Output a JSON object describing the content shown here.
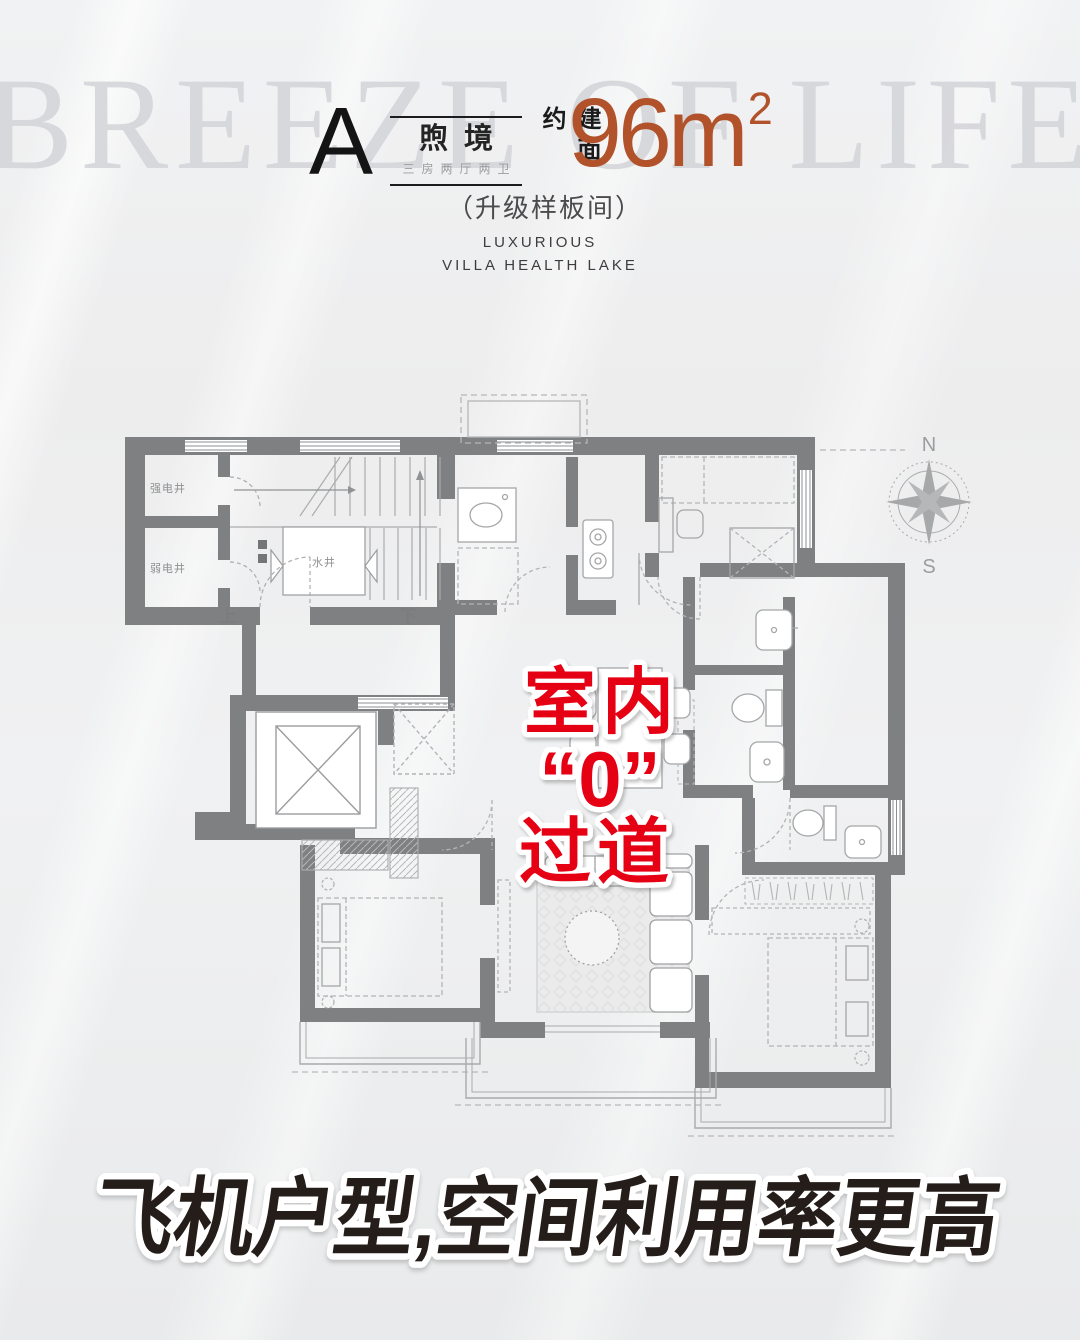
{
  "watermark_text": "BREEZE OF LIFE",
  "header": {
    "unit_letter": "A",
    "series_name": "煦境",
    "room_config": "三房两厅两卫",
    "area_prefix": "建面约",
    "area_number": "96m",
    "area_exponent": "2",
    "upgrade_note": "（升级样板间）",
    "en_tagline_line1": "LUXURIOUS",
    "en_tagline_line2": "VILLA HEALTH LAKE"
  },
  "floor_plan": {
    "shaft_strong_electric": "强电井",
    "shaft_weak_electric": "弱电井",
    "shaft_water": "水井",
    "stair_up": "上",
    "stair_down": "下"
  },
  "compass": {
    "north_label": "N",
    "south_label": "S"
  },
  "highlight": {
    "line1": "室内",
    "line2": "“0”",
    "line3": "过道"
  },
  "footer": {
    "slogan": "飞机户型,空间利用率更高"
  },
  "colors": {
    "highlight_red": "#e60014",
    "area_orange": "#b2522b",
    "wall_gray": "#7e8082",
    "slogan_ink": "#251d19",
    "watermark_gray": "#d3d4d8"
  }
}
